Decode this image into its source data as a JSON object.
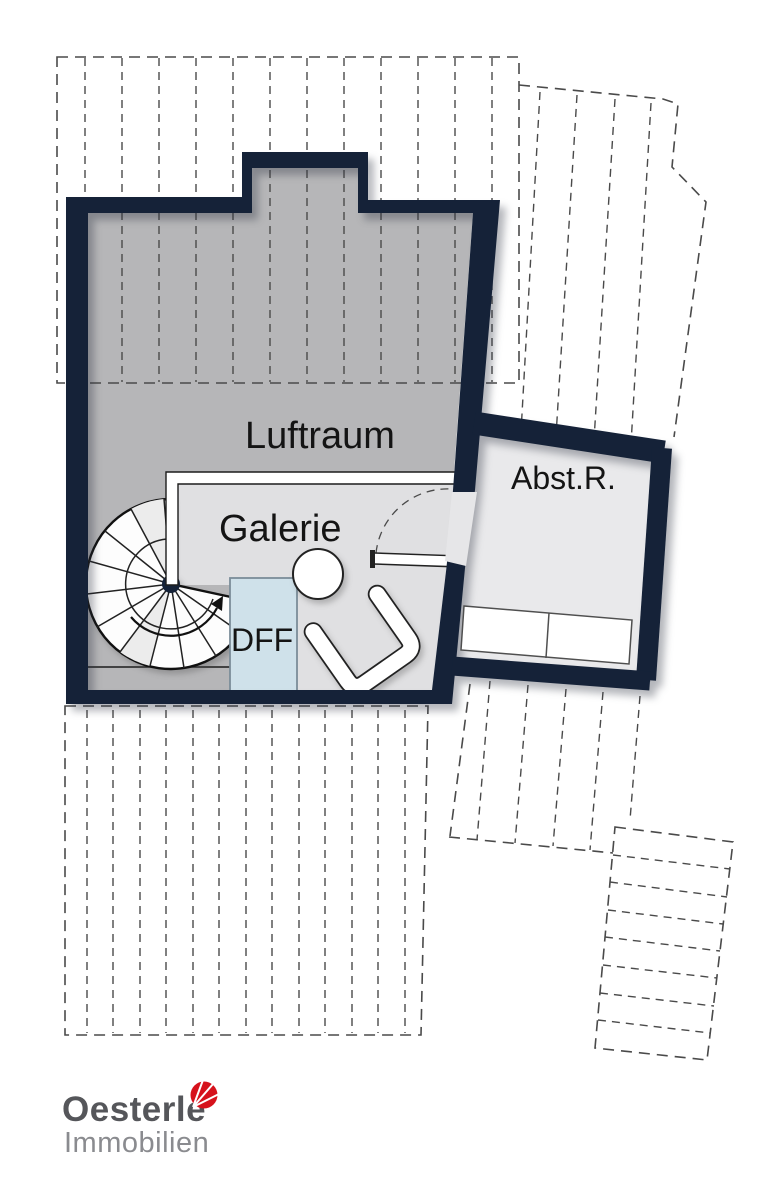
{
  "labels": {
    "luftraum": "Luftraum",
    "galerie": "Galerie",
    "abstellraum": "Abst.R.",
    "dff": "DFF"
  },
  "logo": {
    "name": "Oesterle",
    "subtitle": "Immobilien"
  },
  "colors": {
    "wall": "#152238",
    "luftraum": "#b6b6b8",
    "galerie": "#e0e0e2",
    "abstr": "#e9e9eb",
    "passage": "#e6e6e8",
    "dff": "#cfe1ea",
    "dffborder": "#7b8d99",
    "dash": "#4a4a4a",
    "text": "#141414",
    "logoname": "#55565a",
    "logosub": "#8a8b8f",
    "logored": "#d6121c"
  }
}
